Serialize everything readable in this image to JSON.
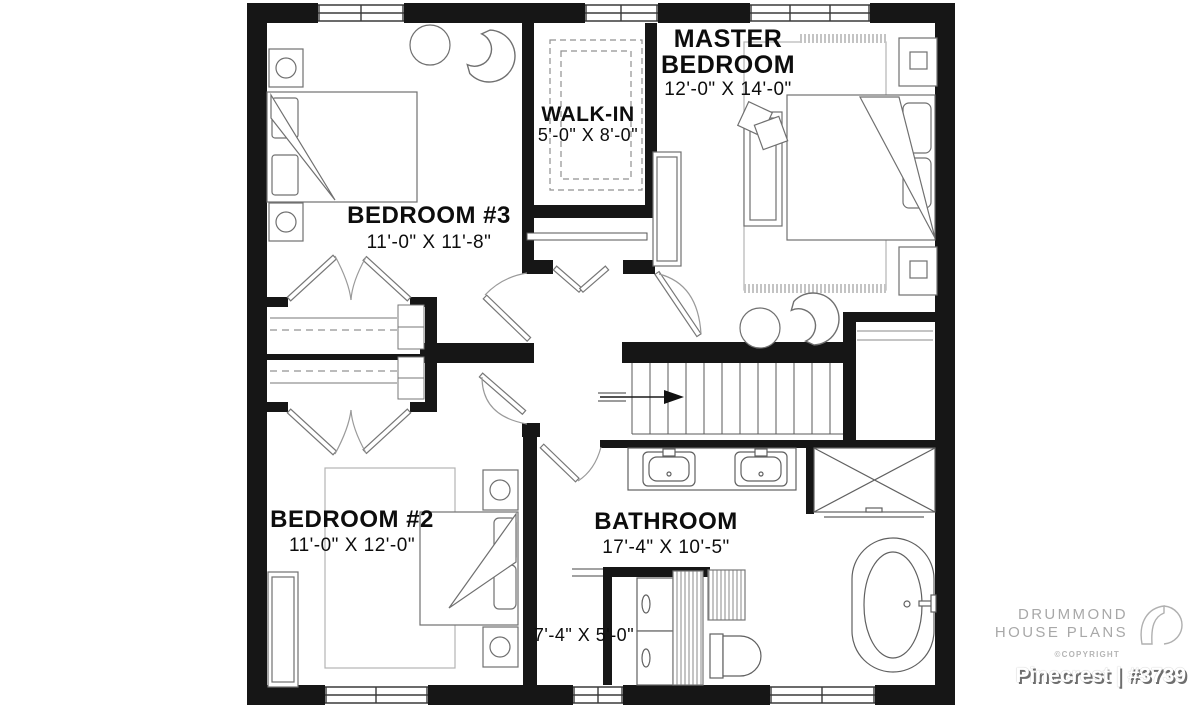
{
  "plan": {
    "rooms": {
      "master_bedroom": {
        "name_line1": "MASTER",
        "name_line2": "BEDROOM",
        "dims": "12'-0\" X 14'-0\""
      },
      "walk_in": {
        "name": "WALK-IN",
        "dims": "5'-0\" X 8'-0\""
      },
      "bedroom_3": {
        "name": "BEDROOM #3",
        "dims": "11'-0\" X 11'-8\""
      },
      "bedroom_2": {
        "name": "BEDROOM #2",
        "dims": "11'-0\" X 12'-0\""
      },
      "bathroom": {
        "name": "BATHROOM",
        "dims": "17'-4\" X 10'-5\""
      },
      "laundry": {
        "dims": "7'-4\" X 5'-0\""
      }
    }
  },
  "branding": {
    "company_line1": "DRUMMOND",
    "company_line2": "HOUSE PLANS",
    "copyright": "©COPYRIGHT",
    "plan_title": "Pinecrest | #3739"
  },
  "colors": {
    "wall": "#161616",
    "furniture": "#707070",
    "brand_gray": "#a8a8a8",
    "background": "#ffffff"
  }
}
